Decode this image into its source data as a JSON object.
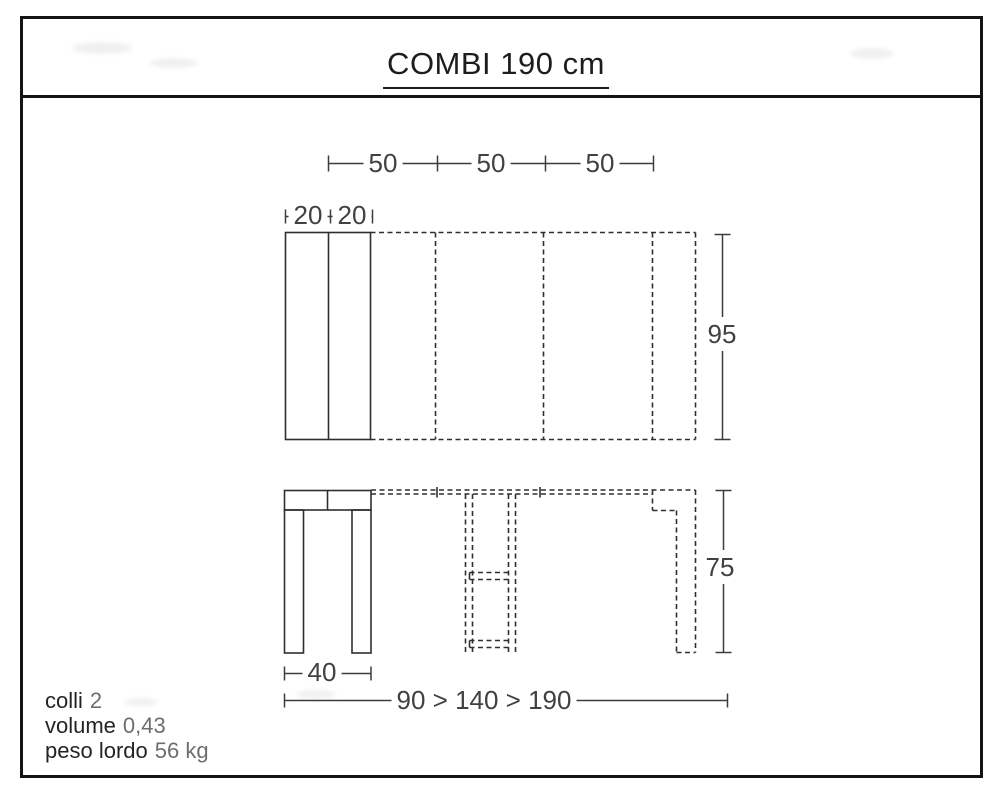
{
  "title": "COMBI 190 cm",
  "plan_view": {
    "leaf_dims": [
      "50",
      "50",
      "50"
    ],
    "closed_top_dims": [
      "20",
      "20"
    ],
    "depth_dim": "95"
  },
  "front_view": {
    "height_dim": "75",
    "base_width_dim": "40",
    "extension_range_dim": "90 > 140 > 190"
  },
  "specs": [
    {
      "label": "colli",
      "value": "2"
    },
    {
      "label": "volume",
      "value": "0,43"
    },
    {
      "label": "peso lordo",
      "value": "56 kg"
    }
  ],
  "colors": {
    "line": "#2f2f2f",
    "dimension_text": "#414141",
    "spec_label_text": "#242424",
    "spec_value_text": "#6e6e6e",
    "frame": "#141414",
    "background": "#ffffff"
  }
}
